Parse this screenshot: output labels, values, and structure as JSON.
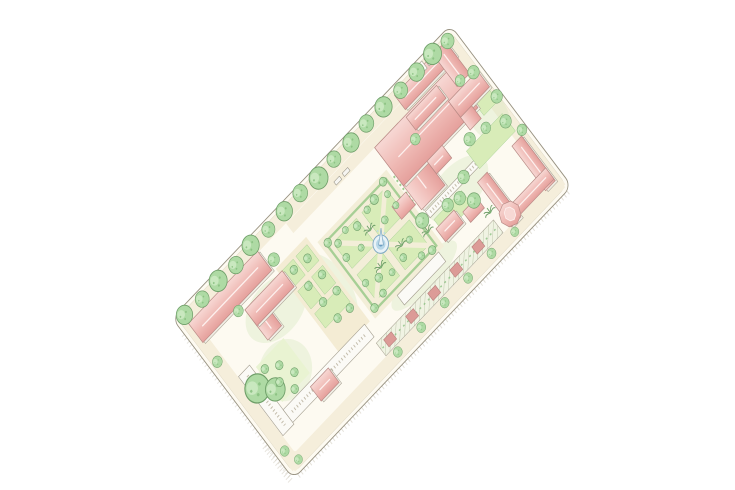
{
  "scene": {
    "background": "#ffffff",
    "style": "hand-drawn watercolor rendering",
    "view": "bird's-eye axonometric site plan",
    "subject": "campus block with courtyards, formal garden and fountain",
    "site_rotation_deg": -46
  },
  "palette": {
    "paper": "#ffffff",
    "outline": "#96907f",
    "ground": "#fdfaf1",
    "band": "#f4ecd4",
    "path": "#f5eedb",
    "garden-path": "#f3eed8",
    "lawn": "#d8ecb8",
    "lawn-pale": "#e9f3d2",
    "hedge": "#9ecb8e",
    "tree": "#aedaa4",
    "tree-edge": "#6f9f69",
    "tree-shade": "#84bd7c",
    "tree-hi": "#d2ecc8",
    "roof-light": "#f7d8d4",
    "roof-mid": "#efb9b4",
    "roof-dark": "#e5a09c",
    "roof-ridge": "#fdf0ee",
    "roof-edge": "#b98b86",
    "wall": "#f0ede4",
    "wall-edge": "#a39d8e",
    "white-roof": "#fbfaf6",
    "arcade-line": "#c3bcab",
    "water": "#e8f2f7",
    "water-mid": "#b7d7e8",
    "water-ring": "#7fa9c4",
    "water-deep": "#5f94bd",
    "pavilion": "#dc9b97",
    "pavilion-edge": "#b97f7c",
    "hatch-line": "#b0b89c",
    "hatch-bg": "#f0f3e3",
    "shadow-tick": "#c9c3b3",
    "car": "#f6f5f1",
    "wash": "#cde5b2"
  },
  "inventory": {
    "site": "rounded rectangular block rotated diagonally, cream paths on all four edges",
    "buildings": [
      "west-long-hall",
      "west-l-building",
      "main-hall",
      "main-hall-west-wing",
      "entry-porch",
      "garden-side-pavilion",
      "northeast-bar",
      "northeast-wing",
      "northeast-courtyard-building",
      "east-cluster-building",
      "u-court-building",
      "octagonal-corner-tower",
      "corner-kiosks",
      "south-pavilion-1",
      "south-pavilion-2",
      "southwest-arcade-1",
      "southwest-arcade-2",
      "south-white-bar",
      "southwest-pink-pavilion",
      "garden-colonnade"
    ],
    "landscape": [
      "perimeter street trees",
      "formal parterre garden with diagonal paths",
      "central fountain with jet",
      "pergola walk with red pavilions",
      "courtyard lawns",
      "twin shade trees",
      "palm accents"
    ],
    "counts": {
      "perimeter_trees": 17,
      "garden_small_trees": 21,
      "garden_palms": 3,
      "red_pergola_pavilions": 5,
      "cars": 4,
      "fountains": 1
    }
  }
}
